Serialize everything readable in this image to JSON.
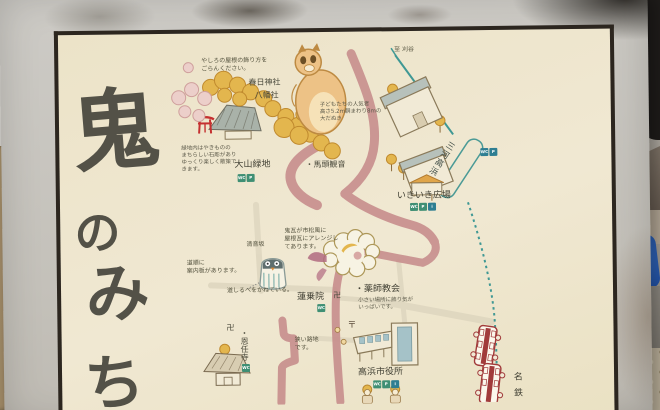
{
  "title": [
    "鬼",
    "の",
    "み",
    "ち"
  ],
  "labels": {
    "kasuga": "春日神社",
    "hachiman": "八幡社",
    "oyama": "大山緑地",
    "bato": "・馬頭観音",
    "to_kariya": "至 刈谷",
    "station": "三河高浜",
    "ikiiki": "いきいき広場",
    "slope": "清音坂",
    "renjoin": "蓮乗院",
    "manji": "卍",
    "yakushi": "・薬師教会",
    "onninji": "・恩任寺",
    "alley_manji": "卍",
    "post_mark": "〒",
    "cityhall": "高浜市役所",
    "meitetsu": "名鉄"
  },
  "notes": {
    "roof": "やしろの屋根の飾り方を\nごらんください。",
    "tanuki": "子どもたちの人気者\n高さ5.2m胴まわり8mの\n大だぬき",
    "ryokuchi": "緑地内はやきものの\nまちらしい石彫があり\nゆっくり楽しく散策で\nきます。",
    "onigawara": "鬼瓦が市松風に\n屋根瓦にアレンジし\nてあります。",
    "guide": "道順に\n案内板があります。",
    "michishirube": "道しるべをかねている。",
    "yakushi_note": "小さい場所に飾り気が\nいっぱいです。",
    "alley": "狭い路地\nです。"
  },
  "facilities": {
    "oyama": [
      "WC",
      "P"
    ],
    "station": [
      "WC",
      "P"
    ],
    "ikiiki": [
      "WC",
      "P",
      "i"
    ],
    "renjoin": [
      "WC"
    ],
    "onninji": [
      "WC"
    ],
    "cityhall": [
      "WC",
      "P",
      "i"
    ]
  },
  "colors": {
    "panel_bg": "#ece3c8",
    "road_pink": "#c8908e",
    "rail_teal": "#3f9894",
    "tree_yellow": "#e3b64e",
    "torii_red": "#c53030",
    "train_red": "#a13b3b",
    "icon_green": "#3f8f74",
    "ink": "#4b4a3c",
    "frame_gray": "#c4c1ba"
  }
}
